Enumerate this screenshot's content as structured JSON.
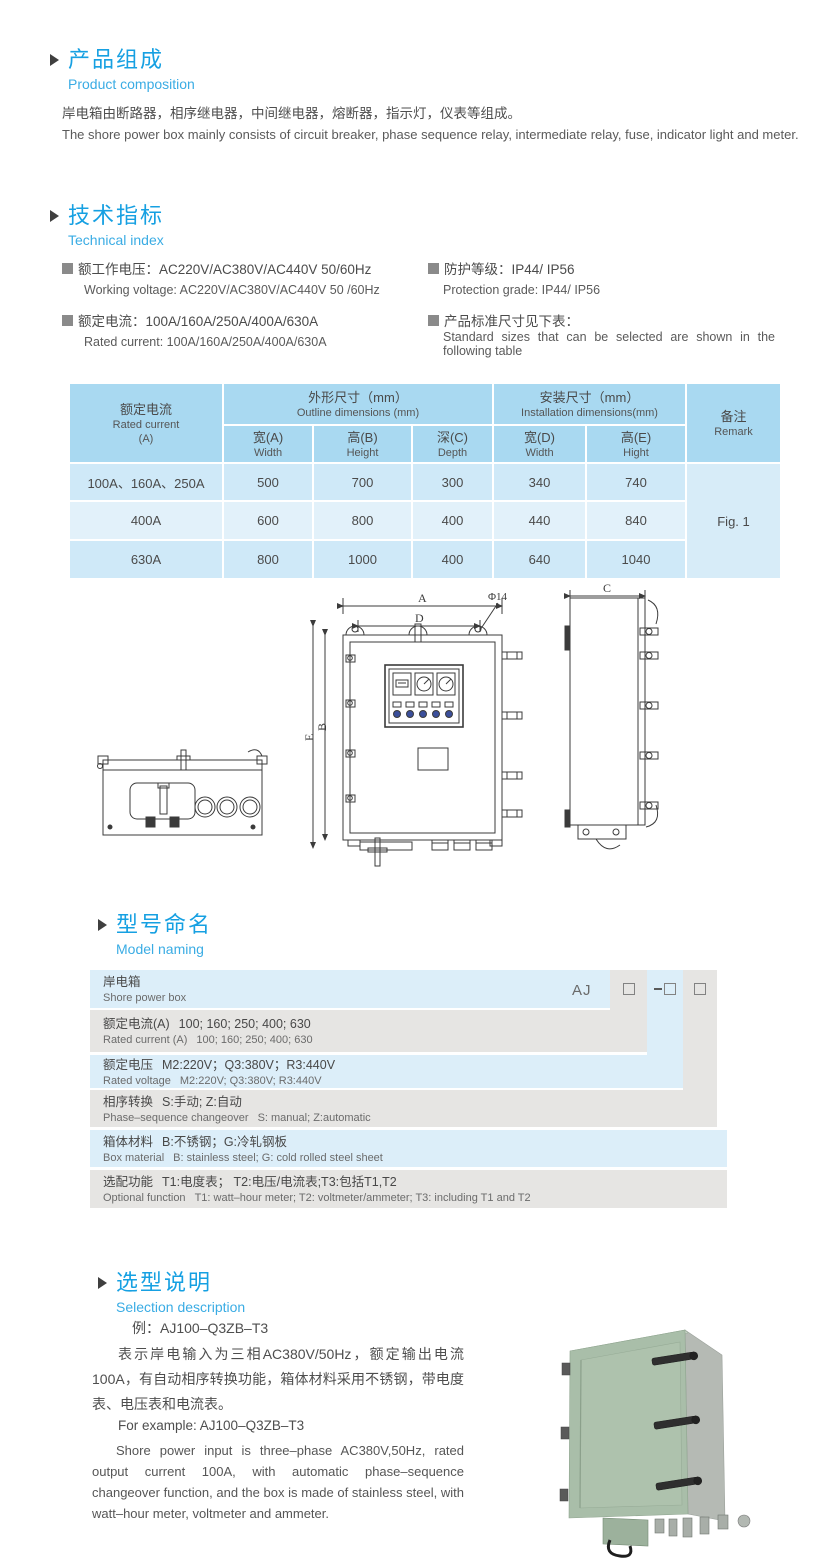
{
  "colors": {
    "accent_blue": "#16a0e2",
    "accent_blue_light": "#3aace4",
    "table_header": "#a9d9f1",
    "table_row_odd": "#cfe9f8",
    "table_row_even": "#e2f1fa",
    "naming_blue": "#dceef9",
    "naming_gray": "#e6e5e3",
    "photo_green": "#a9bea9"
  },
  "composition": {
    "title_zh": "产品组成",
    "title_en": "Product  composition",
    "body_zh": "岸电箱由断路器，相序继电器，中间继电器，熔断器，指示灯，仪表等组成。",
    "body_en": "The shore power box mainly consists of circuit breaker, phase sequence relay, intermediate relay, fuse, indicator light and meter."
  },
  "technical": {
    "title_zh": "技术指标",
    "title_en": "Technical index",
    "items": [
      {
        "zh": "额工作电压：AC220V/AC380V/AC440V  50/60Hz",
        "en": "Working voltage: AC220V/AC380V/AC440V 50 /60Hz"
      },
      {
        "zh": "额定电流：100A/160A/250A/400A/630A",
        "en": "Rated current: 100A/160A/250A/400A/630A"
      },
      {
        "zh": "防护等级：IP44/ IP56",
        "en": "Protection grade: IP44/ IP56"
      },
      {
        "zh": "产品标准尺寸见下表：",
        "en": "Standard sizes that can be selected are shown in the following table"
      }
    ]
  },
  "size_table": {
    "header": {
      "rated_current_zh": "额定电流",
      "rated_current_en": "Rated current",
      "rated_current_unit": "(A)",
      "outline_zh": "外形尺寸（mm）",
      "outline_en": "Outline dimensions (mm)",
      "install_zh": "安装尺寸（mm）",
      "install_en": "Installation dimensions(mm)",
      "remark_zh": "备注",
      "remark_en": "Remark",
      "cols": [
        {
          "zh": "宽(A)",
          "en": "Width"
        },
        {
          "zh": "高(B)",
          "en": "Height"
        },
        {
          "zh": "深(C)",
          "en": "Depth"
        },
        {
          "zh": "宽(D)",
          "en": "Width"
        },
        {
          "zh": "高(E)",
          "en": "Hight"
        }
      ]
    },
    "rows": [
      {
        "current": "100A、160A、250A",
        "v0": "500",
        "v1": "700",
        "v2": "300",
        "v3": "340",
        "v4": "740"
      },
      {
        "current": "400A",
        "v0": "600",
        "v1": "800",
        "v2": "400",
        "v3": "440",
        "v4": "840"
      },
      {
        "current": "630A",
        "v0": "800",
        "v1": "1000",
        "v2": "400",
        "v3": "640",
        "v4": "1040"
      }
    ],
    "remark": "Fig. 1"
  },
  "drawing": {
    "dim_a": "A",
    "dim_d": "D",
    "dim_phi": "Φ14",
    "dim_e": "E",
    "dim_b": "B",
    "dim_c": "C"
  },
  "naming": {
    "title_zh": "型号命名",
    "title_en": "Model naming",
    "prefix": "AJ",
    "rows": [
      {
        "zh": "岸电箱",
        "zh_desc": "",
        "en": "Shore power box",
        "en_desc": ""
      },
      {
        "zh": "额定电流(A)",
        "zh_desc": "100; 160; 250; 400; 630",
        "en": "Rated current (A)",
        "en_desc": "100; 160; 250; 400; 630"
      },
      {
        "zh": "额定电压",
        "zh_desc": "M2:220V；Q3:380V；R3:440V",
        "en": "Rated voltage",
        "en_desc": "M2:220V;  Q3:380V;  R3:440V"
      },
      {
        "zh": "相序转换",
        "zh_desc": "S:手动; Z:自动",
        "en": "Phase–sequence changeover",
        "en_desc": "S: manual;  Z:automatic"
      },
      {
        "zh": "箱体材料",
        "zh_desc": "B:不锈钢；G:冷轧钢板",
        "en": "Box material",
        "en_desc": "B: stainless steel; G: cold rolled steel sheet"
      },
      {
        "zh": "选配功能",
        "zh_desc": "T1:电度表； T2:电压/电流表;T3:包括T1,T2",
        "en": "Optional function",
        "en_desc": "T1: watt–hour meter; T2: voltmeter/ammeter; T3: including T1 and T2"
      }
    ]
  },
  "selection": {
    "title_zh": "选型说明",
    "title_en": "Selection description",
    "example_zh": "例：AJ100–Q3ZB–T3",
    "body_zh": "表示岸电输入为三相AC380V/50Hz，额定输出电流100A，有自动相序转换功能，箱体材料采用不锈钢，带电度表、电压表和电流表。",
    "example_en": "For example: AJ100–Q3ZB–T3",
    "body_en": "Shore power input is three–phase AC380V,50Hz, rated output current 100A, with automatic phase–sequence changeover function, and the box is made of stainless steel, with watt–hour meter, voltmeter and ammeter."
  }
}
